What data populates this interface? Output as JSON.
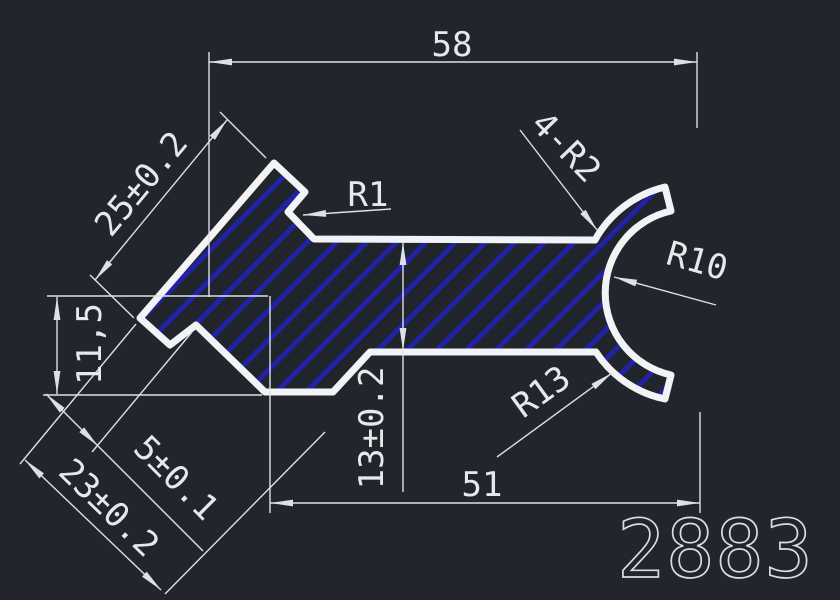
{
  "drawing": {
    "part_number": "2883",
    "labels": {
      "top_width": "58",
      "arm_length": "25±0.2",
      "notch_radius": "R1",
      "tip_fillets": "4-R2",
      "inner_radius": "R10",
      "outer_radius": "R13",
      "left_height": "11,5",
      "step_width": "5±0.1",
      "foot_width": "23±0.2",
      "web_thickness": "13±0.2",
      "bottom_width": "51"
    },
    "colors": {
      "background": "#22262c",
      "outline": "#f2f3f5",
      "hatch": "#2222a4",
      "dimension": "#dde1e5"
    }
  }
}
